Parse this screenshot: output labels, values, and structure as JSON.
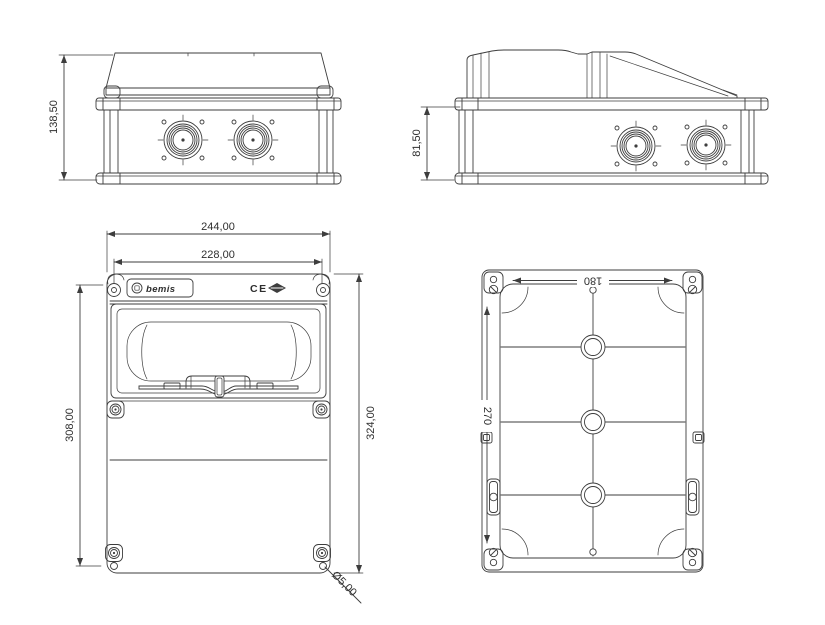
{
  "drawing": {
    "background": "#ffffff",
    "line_color": "#3d3d3d",
    "views": {
      "side": {
        "label": "side view",
        "height_dim": "138,50"
      },
      "profile": {
        "label": "profile view",
        "height_dim": "81,50"
      },
      "front": {
        "label": "front view",
        "overall_width_dim": "244,00",
        "mount_width_dim": "228,00",
        "mount_height_dim": "308,00",
        "overall_height_dim": "324,00",
        "corner_hole_dia_dim": "Ø5,00",
        "brand": "bemis",
        "ce_mark": "CE"
      },
      "back": {
        "label": "back view",
        "inner_width_dim": "180",
        "inner_height_dim": "270"
      }
    }
  }
}
